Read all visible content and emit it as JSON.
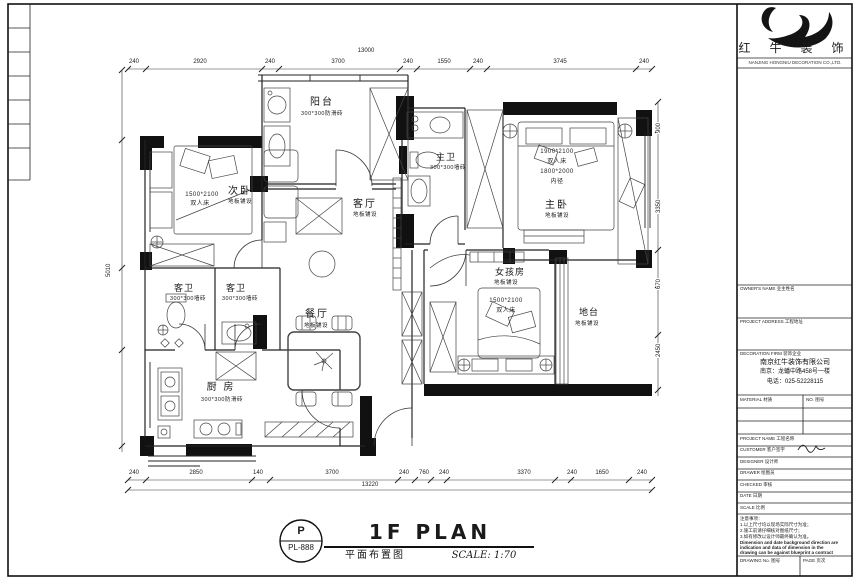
{
  "logo": {
    "company": "红 牛 装 饰",
    "tagline": "NANJING HONGNIU DECORATION CO.,LTD."
  },
  "titleblock": {
    "row_owner": "OWNER'S NAME 业主姓名",
    "row_address": "PROJECT ADDRESS 工程地址",
    "company_header": "DECORATION FIRM 装饰企业",
    "company_name": "南京红牛装饰有限公司",
    "company_address": "南京：龙蟠中路458号一楼",
    "company_phone": "电话：025-52228115",
    "material_label": "MATERIAL 材质",
    "no_label": "NO. 图号",
    "rows": [
      "PROJECT NAME 工程名称",
      "CUSTOMER 客户签字",
      "DESIGNER 设计师",
      "DRAWER 绘图员",
      "CHECKED 审核",
      "DATE 日期",
      "SCALE 比例"
    ],
    "notes_title": "注意事项：",
    "notes_cn": [
      "1.以上尺寸均以现场实际尺寸为准；",
      "2.施工前请仔细核对图纸尺寸；",
      "3.如有修改以设计师最终确认为准。"
    ],
    "notes_en": [
      "Dimension and date background direction are",
      "indication and data of dimension in the",
      "drawing can be against blueprint a contract"
    ],
    "drawing_no_label": "DRAWING No. 图号",
    "page_label": "PAGE 页次"
  },
  "rooms": {
    "balcony": {
      "name": "阳台",
      "sub": "300*300防滑砖"
    },
    "second_bedroom": {
      "name": "次卧",
      "sub": "地板铺设",
      "note1": "1500*2100",
      "note2": "双人床"
    },
    "living": {
      "name": "客厅",
      "sub": "地板铺设"
    },
    "master_bath": {
      "name": "主卫",
      "sub": "300*300墙砖"
    },
    "master_bedroom": {
      "name": "主卧",
      "sub": "地板铺设",
      "note1": "1900*2100",
      "note2": "双人床",
      "note3": "1800*2000",
      "note4": "内径"
    },
    "girl_room": {
      "name": "女孩房",
      "sub": "地板铺设",
      "note1": "1500*2100",
      "note2": "双人床"
    },
    "platform": {
      "name": "地台",
      "sub": "地板铺设"
    },
    "guest_bath_1": {
      "name": "客卫",
      "sub": "300*300墙砖"
    },
    "guest_bath_2": {
      "name": "客卫",
      "sub": "300*300墙砖"
    },
    "kitchen": {
      "name": "厨 房",
      "sub": "300*300防滑砖"
    },
    "dining": {
      "name": "餐厅",
      "sub": "地板铺设"
    }
  },
  "dims": {
    "top": {
      "total": "13000",
      "segs": [
        "240",
        "2920",
        "240",
        "3700",
        "240",
        "1550",
        "240",
        "3745",
        "240"
      ]
    },
    "bottom": {
      "total": "13220",
      "segs": [
        "240",
        "2850",
        "140",
        "3700",
        "240",
        "760",
        "240",
        "3370",
        "240",
        "1650",
        "240"
      ]
    },
    "left": {
      "total": "5010"
    },
    "right": {
      "segs": [
        "900",
        "3350",
        "670",
        "2450"
      ]
    }
  },
  "footer": {
    "letter": "P",
    "code": "PL-888",
    "title_en": "1F PLAN",
    "title_cn": "平面布置图",
    "scale": "SCALE: 1:70"
  }
}
